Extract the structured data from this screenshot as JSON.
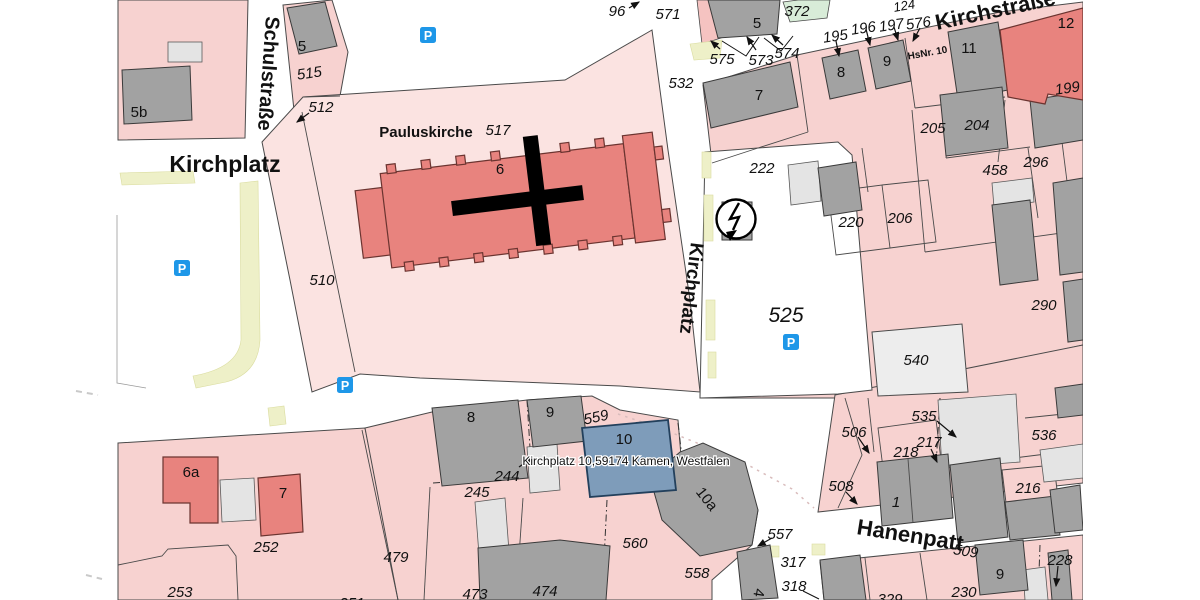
{
  "map": {
    "streets": {
      "schulstrasse": "Schulstraße",
      "kirchplatz_plaza": "Kirchplatz",
      "kirchplatz_street": "Kirchplatz",
      "kirchstrasse": "Kirchstraße",
      "hanenpatt": "Hanenpatt"
    },
    "poi": {
      "pauluskirche": "Pauluskirche",
      "address_label": "Kirchplatz 10,59174 Kamen, Westfalen",
      "hs_nr": "HsNr. 10"
    },
    "parcel_numbers": {
      "p96": "96",
      "p124": "124",
      "p195": "195",
      "p196": "196",
      "p197": "197",
      "p199": "199",
      "p204": "204",
      "p205": "205",
      "p206": "206",
      "p216": "216",
      "p217": "217",
      "p218": "218",
      "p220": "220",
      "p222": "222",
      "p228": "228",
      "p230": "230",
      "p244": "244",
      "p245": "245",
      "p251": "251",
      "p252": "252",
      "p253": "253",
      "p290": "290",
      "p296": "296",
      "p317": "317",
      "p318": "318",
      "p329": "329",
      "p372": "372",
      "p458": "458",
      "p473": "473",
      "p474": "474",
      "p479": "479",
      "p506": "506",
      "p508": "508",
      "p509": "509",
      "p510": "510",
      "p512": "512",
      "p515": "515",
      "p517": "517",
      "p525": "525",
      "p532": "532",
      "p535": "535",
      "p536": "536",
      "p540": "540",
      "p557": "557",
      "p558": "558",
      "p559": "559",
      "p560": "560",
      "p571": "571",
      "p573": "573",
      "p574": "574",
      "p575": "575",
      "p576": "576"
    },
    "building_numbers": {
      "b1": "1",
      "b4": "4",
      "b5_left": "5",
      "b5_top": "5",
      "b5b": "5b",
      "b6": "6",
      "b6a": "6a",
      "b7_top": "7",
      "b7_sw": "7",
      "b8_top": "8",
      "b8_s": "8",
      "b9_top": "9",
      "b9_s": "9",
      "b9_se": "9",
      "b10": "10",
      "b10a": "10a",
      "b11": "11",
      "b12": "12"
    },
    "icons": {
      "parking": "P"
    },
    "colors": {
      "parcel_pink": "#f7d2d0",
      "parcel_light_pink": "#fbe3e1",
      "building_gray": "#a2a2a2",
      "building_light_gray": "#e4e4e4",
      "building_red": "#e8837e",
      "selected_blue": "#7e9cba",
      "parcel_green": "#d8ecd8",
      "street_edge_yellow": "#eef0c8",
      "parking_blue": "#1e97e8"
    }
  }
}
